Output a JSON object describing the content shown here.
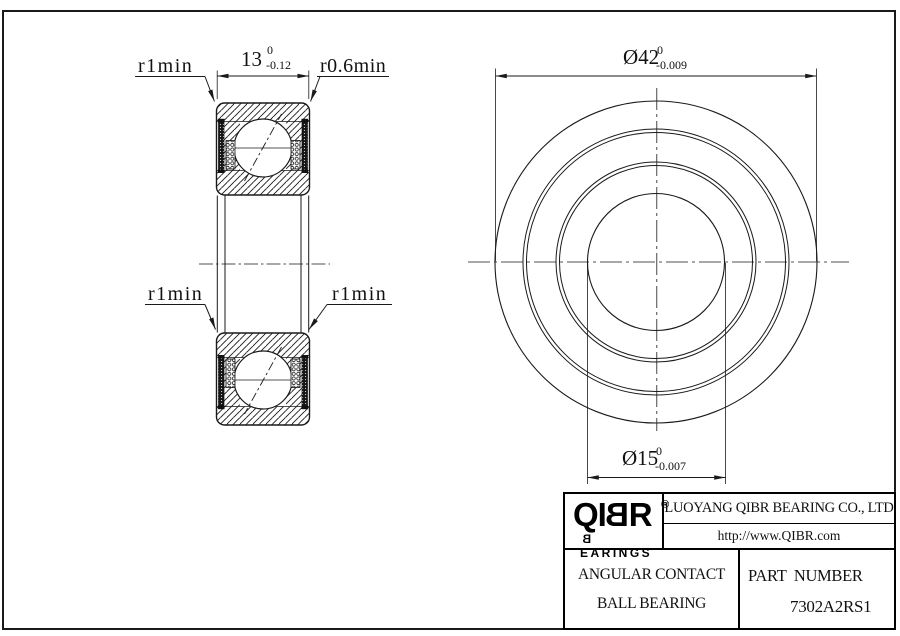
{
  "sheet": {
    "line_color": "#1a1a1a",
    "background": "#ffffff"
  },
  "section_view": {
    "label_r1min_top_left": "r1min",
    "label_r06min_top_right": "r0.6min",
    "label_r1min_bottom_left": "r1min",
    "label_r1min_bottom_right": "r1min",
    "width_dim": {
      "value": "13",
      "tol_upper": "0",
      "tol_lower": "-0.12"
    }
  },
  "front_view": {
    "outer_dia_dim": {
      "value": "Ø42",
      "tol_upper": "0",
      "tol_lower": "-0.009"
    },
    "bore_dia_dim": {
      "value": "Ø15",
      "tol_upper": "0",
      "tol_lower": "-0.007"
    }
  },
  "title_block": {
    "logo": {
      "prefix": "QI",
      "b": "B",
      "suffix": "R",
      "registered": "®",
      "brand_b": "B",
      "brand_rest": "EARINGS"
    },
    "company_name": "LUOYANG QIBR BEARING CO., LTD",
    "website": "http://www.QIBR.com",
    "product_line1": "ANGULAR CONTACT",
    "product_line2": "BALL BEARING",
    "part_number_label": "PART  NUMBER",
    "part_number": "7302A2RS1"
  }
}
